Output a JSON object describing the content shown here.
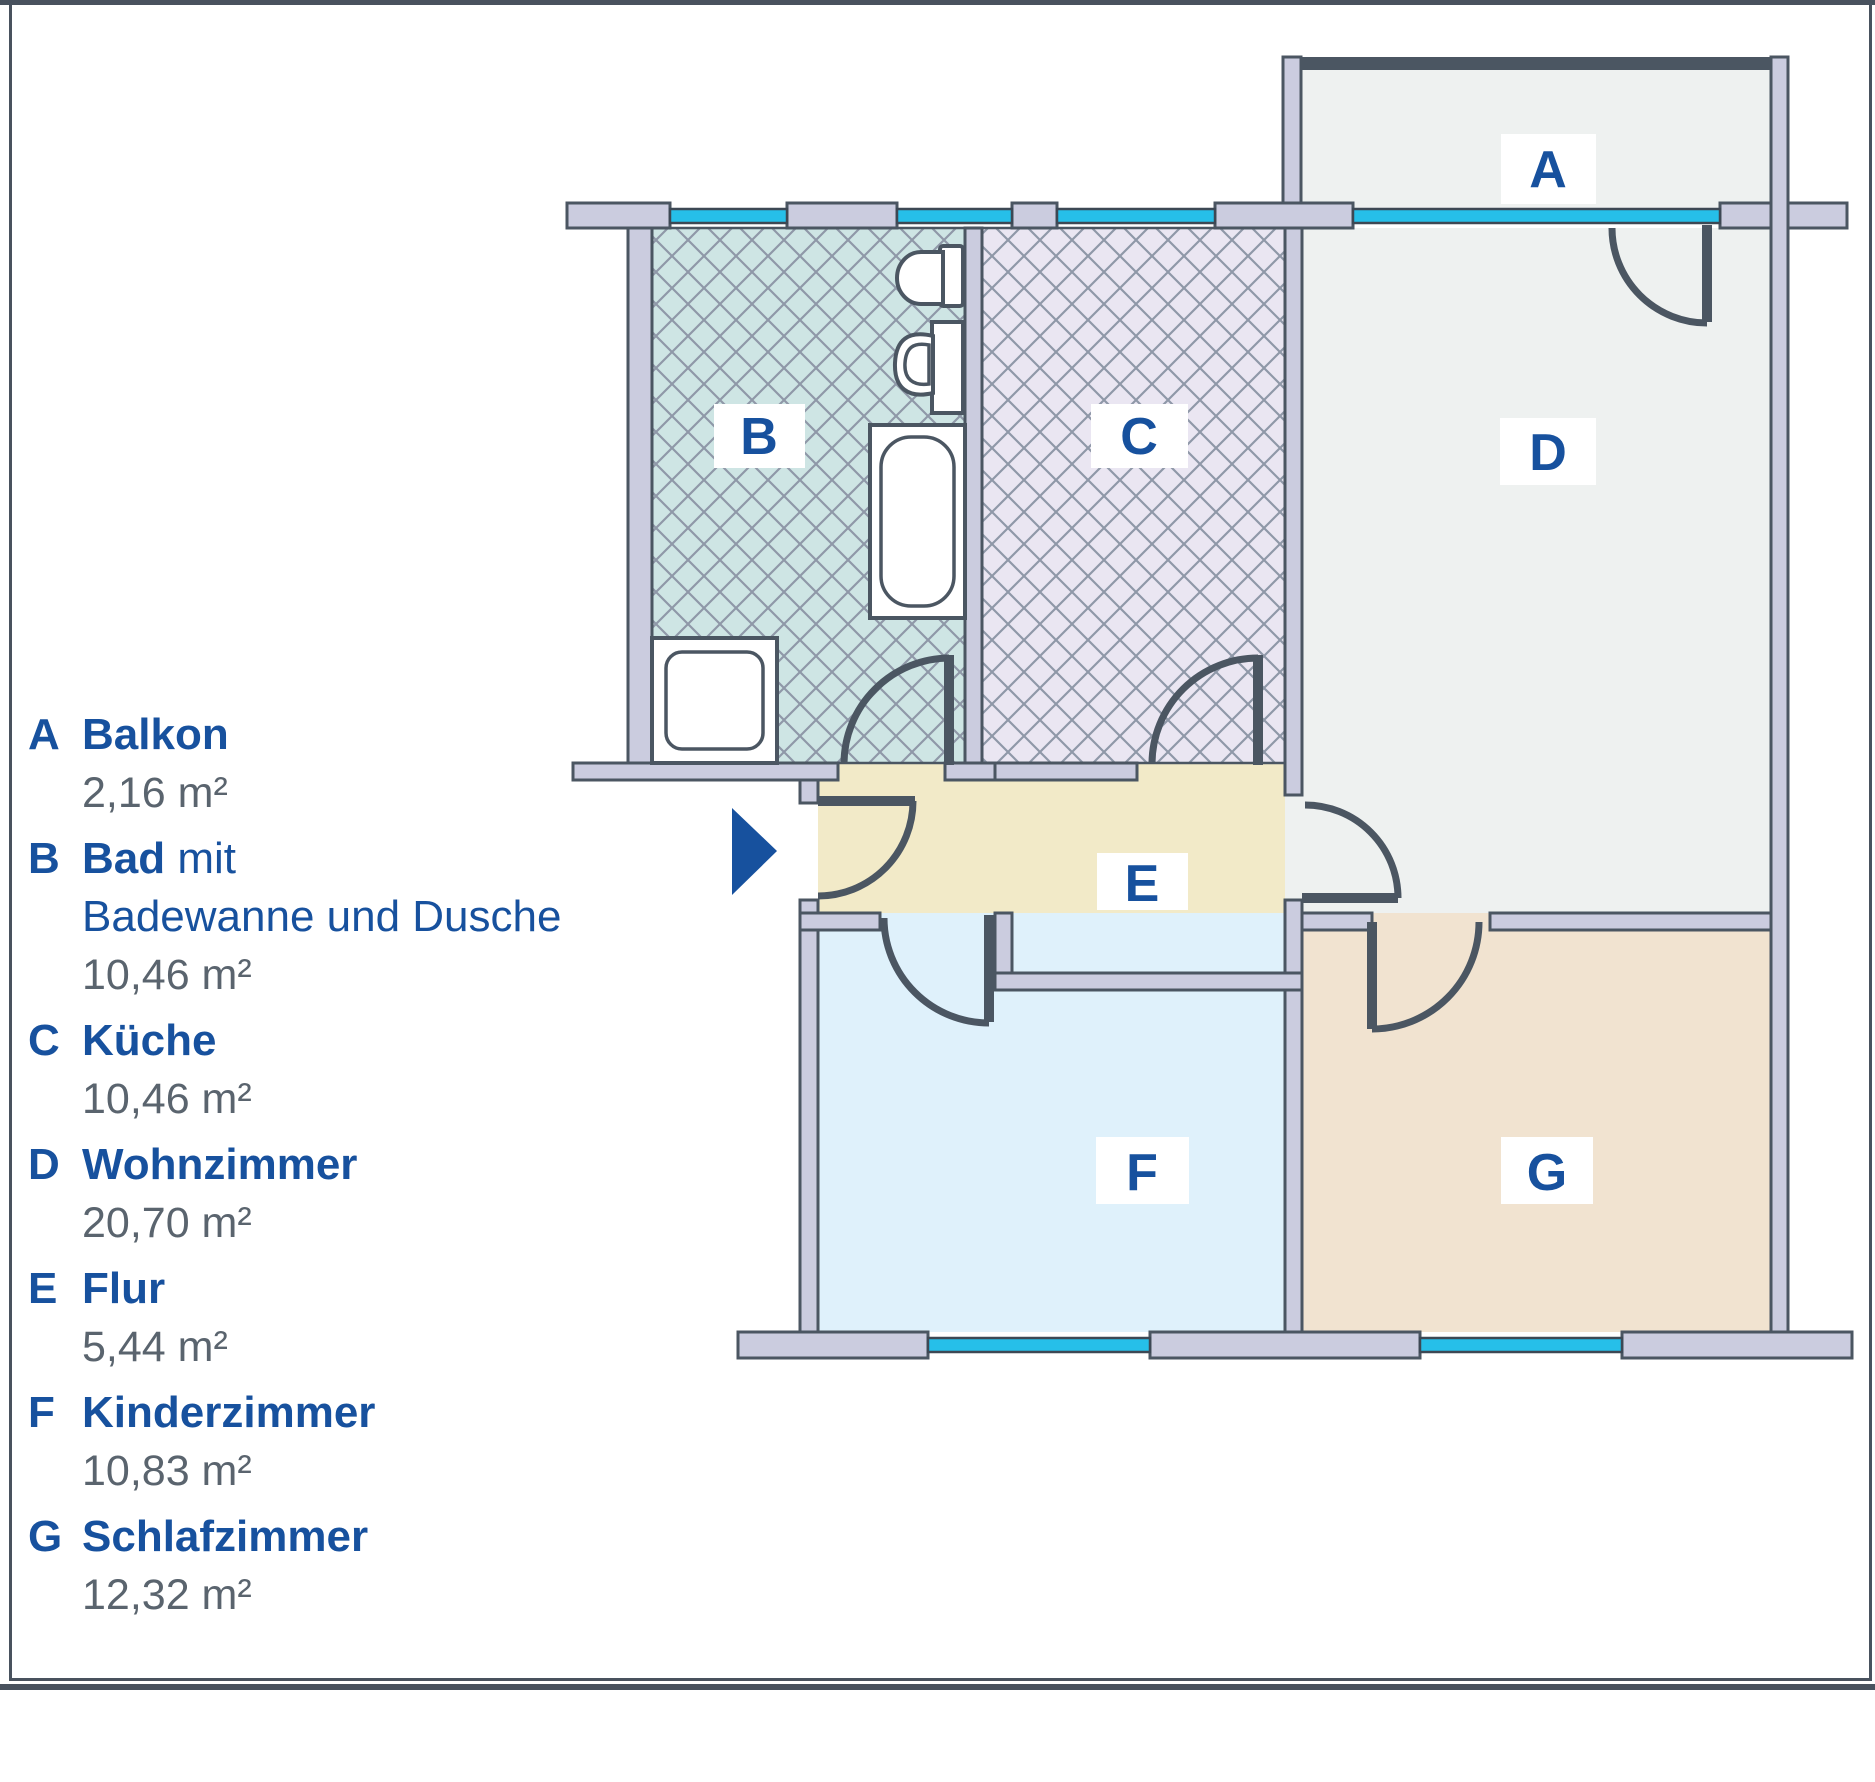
{
  "colors": {
    "accent_blue": "#17519e",
    "text_gray": "#5a646e",
    "wall_fill": "#cbccdf",
    "outline": "#4b5662",
    "window_cyan": "#26bfe9",
    "balcony_fill": "#eef1f0",
    "bath_fill": "#cee5e4",
    "kitchen_fill": "#eae6f2",
    "living_fill": "#eef1f0",
    "hall_fill": "#f2eac8",
    "child_fill": "#dff1fb",
    "bed_fill": "#f1e3d0"
  },
  "rooms": [
    {
      "letter": "A",
      "name": "Balkon",
      "area": "2,16 m²"
    },
    {
      "letter": "B",
      "name": "Bad",
      "name_suffix": " mit",
      "line2": "Badewanne und Dusche",
      "area": "10,46 m²"
    },
    {
      "letter": "C",
      "name": "Küche",
      "area": "10,46 m²"
    },
    {
      "letter": "D",
      "name": "Wohnzimmer",
      "area": "20,70 m²"
    },
    {
      "letter": "E",
      "name": "Flur",
      "area": "5,44 m²"
    },
    {
      "letter": "F",
      "name": "Kinderzimmer",
      "area": "10,83 m²"
    },
    {
      "letter": "G",
      "name": "Schlafzimmer",
      "area": "12,32 m²"
    }
  ]
}
